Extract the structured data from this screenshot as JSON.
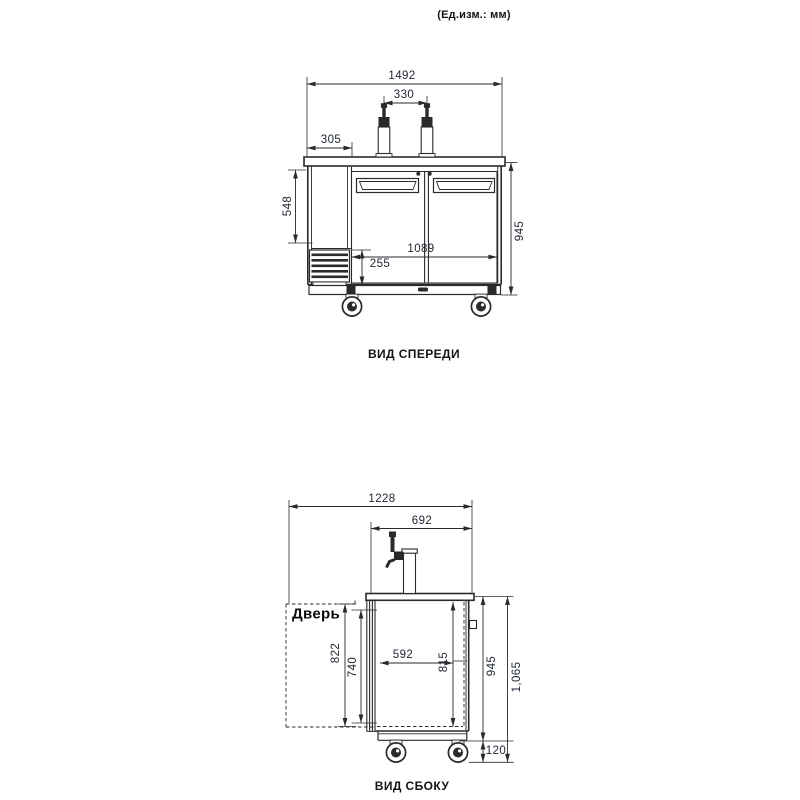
{
  "units_note": "(Ед.изм.: мм)",
  "front_view": {
    "caption": "ВИД СПЕРЕДИ",
    "dims": {
      "overall_width": "1492",
      "tap_spacing": "330",
      "left_section_width": "305",
      "left_panel_height": "548",
      "door_section_width": "1089",
      "grille_height": "255",
      "body_height": "945"
    }
  },
  "side_view": {
    "caption": "ВИД СБОКУ",
    "door_label": "Дверь",
    "dims": {
      "overall_depth": "1228",
      "counter_depth": "692",
      "door_height": "822",
      "door_opening_height": "740",
      "interior_depth": "592",
      "interior_height": "815",
      "body_height": "945",
      "overall_height": "1,065",
      "caster_height": "120"
    }
  },
  "colors": {
    "line": "#2a2a2a",
    "dim_text": "#1d2430",
    "background": "#ffffff"
  }
}
